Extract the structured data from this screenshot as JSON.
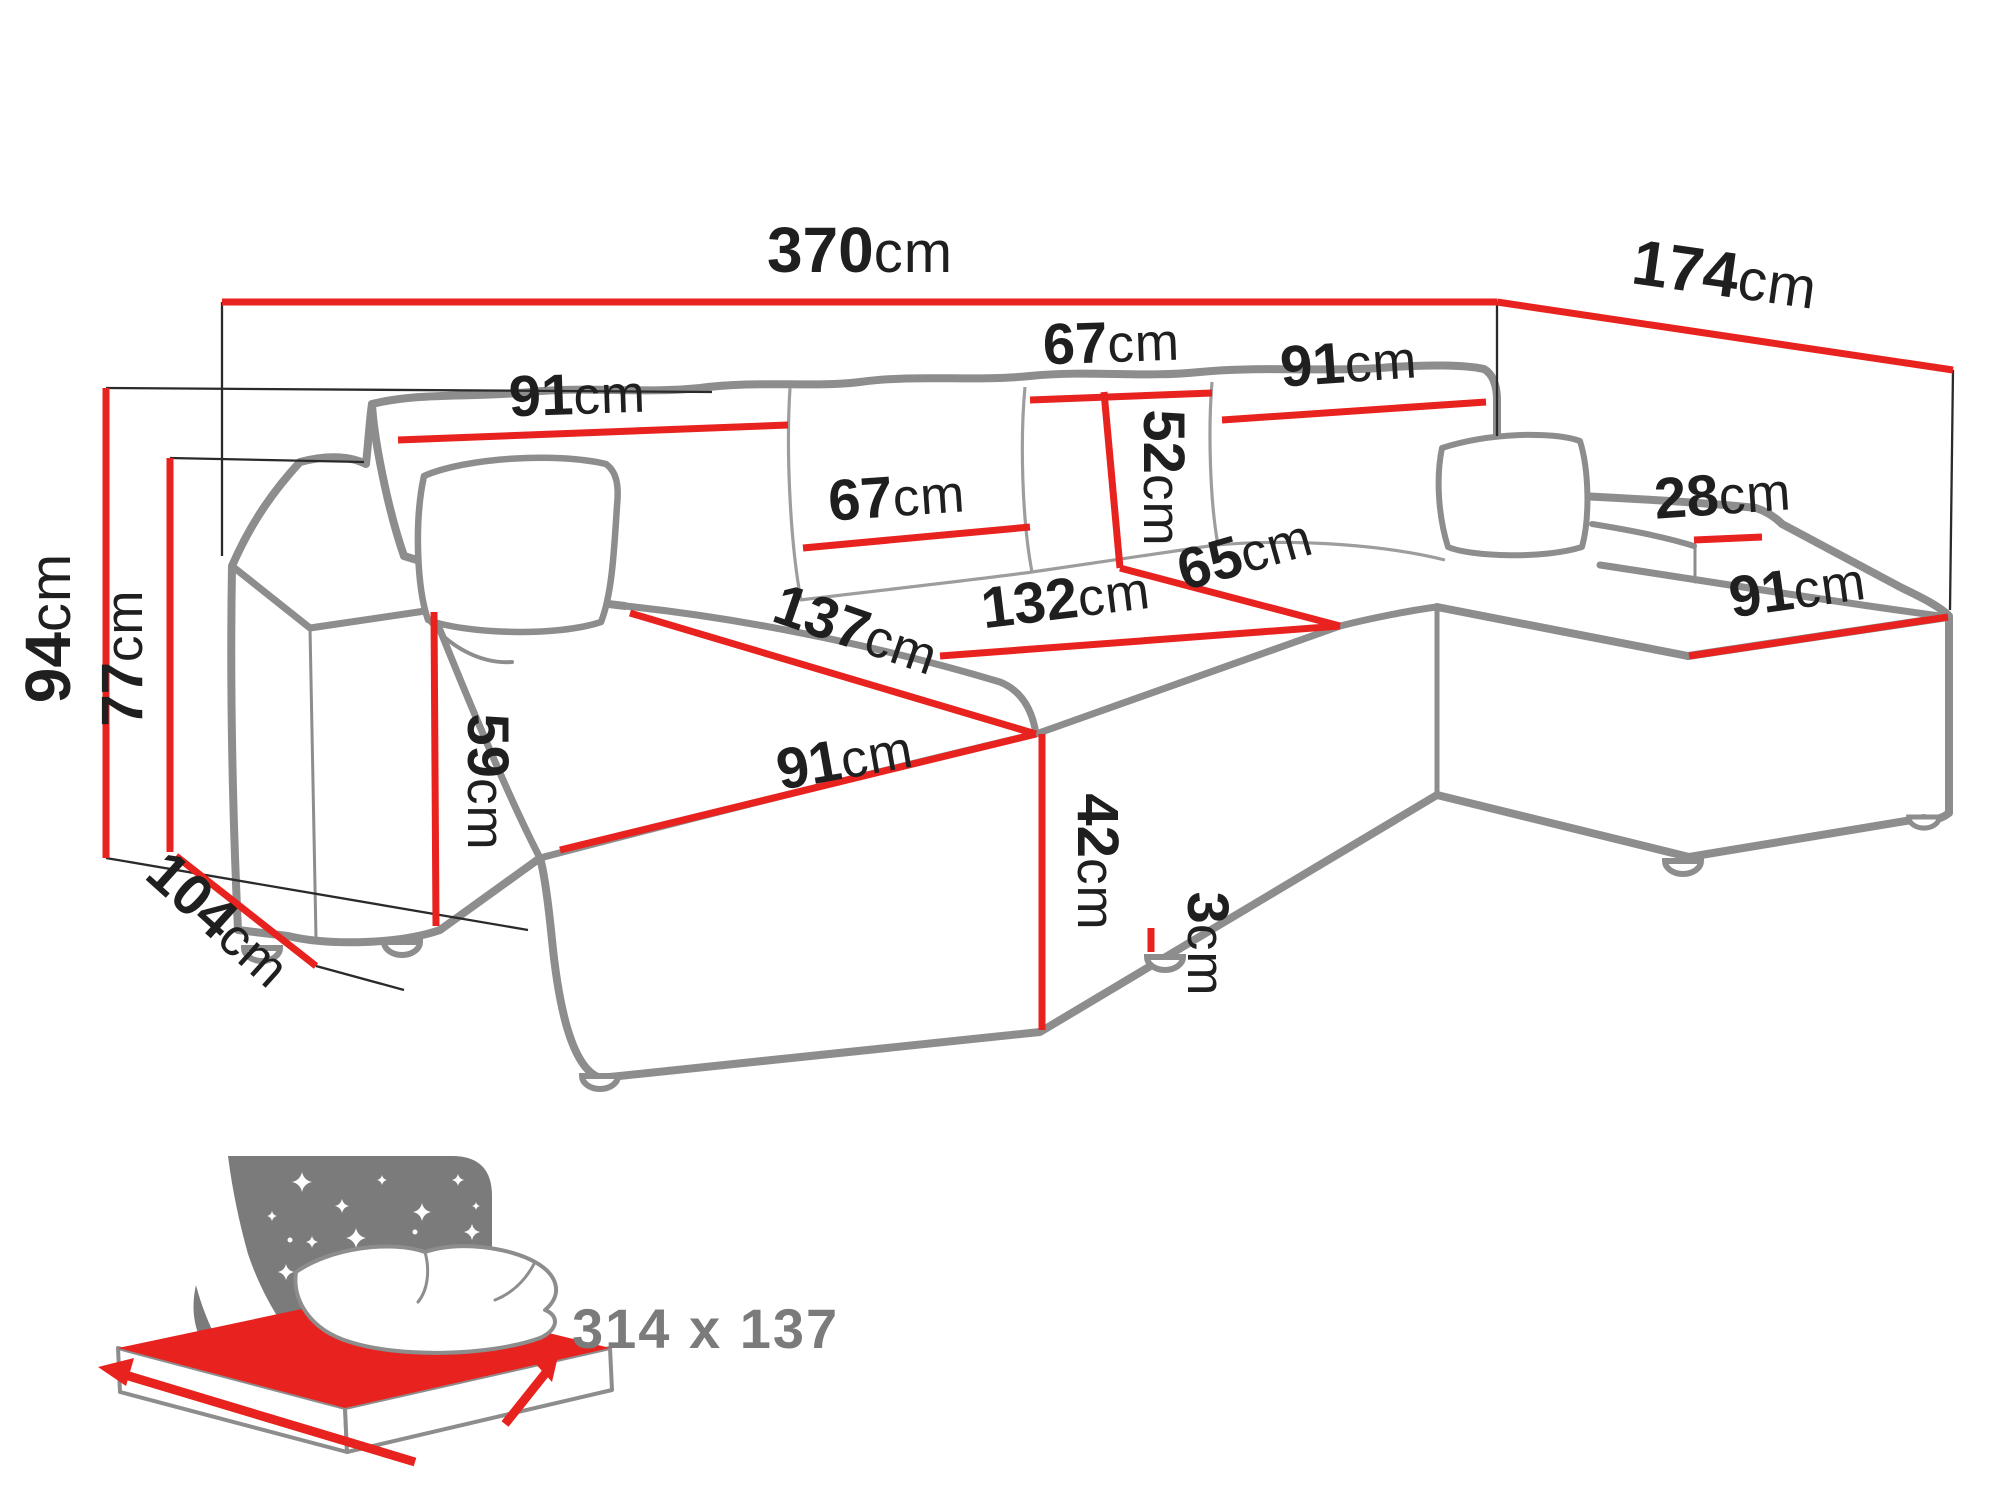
{
  "diagram": {
    "type": "furniture-dimension-diagram",
    "subject": "U-shaped corner sofa bed with measurements",
    "dimensions": [
      {
        "id": "total-width",
        "value": "370",
        "unit": "cm"
      },
      {
        "id": "total-depth-right",
        "value": "174",
        "unit": "cm"
      },
      {
        "id": "total-height",
        "value": "94",
        "unit": "cm"
      },
      {
        "id": "armrest-height",
        "value": "77",
        "unit": "cm"
      },
      {
        "id": "left-arm-depth",
        "value": "104",
        "unit": "cm"
      },
      {
        "id": "backrest-left-width",
        "value": "91",
        "unit": "cm"
      },
      {
        "id": "back-cushion-mid-width",
        "value": "67",
        "unit": "cm"
      },
      {
        "id": "back-cushion-top-width",
        "value": "67",
        "unit": "cm"
      },
      {
        "id": "back-cushion-height",
        "value": "52",
        "unit": "cm"
      },
      {
        "id": "backrest-right-width",
        "value": "91",
        "unit": "cm"
      },
      {
        "id": "right-armrest-width",
        "value": "28",
        "unit": "cm"
      },
      {
        "id": "right-chaise-width",
        "value": "91",
        "unit": "cm"
      },
      {
        "id": "mid-seat-depth",
        "value": "65",
        "unit": "cm"
      },
      {
        "id": "mid-seat-width",
        "value": "132",
        "unit": "cm"
      },
      {
        "id": "left-chaise-length",
        "value": "137",
        "unit": "cm"
      },
      {
        "id": "left-chaise-width",
        "value": "91",
        "unit": "cm"
      },
      {
        "id": "seat-height",
        "value": "42",
        "unit": "cm"
      },
      {
        "id": "side-board-height",
        "value": "59",
        "unit": "cm"
      },
      {
        "id": "leg-height",
        "value": "3",
        "unit": "cm"
      }
    ],
    "sleeping_area": {
      "label": "314 x 137"
    },
    "colors": {
      "dimension_red": "#e8221e",
      "sofa_outline_gray": "#8d8d8d",
      "label_black": "#1f1f1f",
      "icon_gray": "#7b7b7b",
      "background": "#ffffff"
    }
  }
}
